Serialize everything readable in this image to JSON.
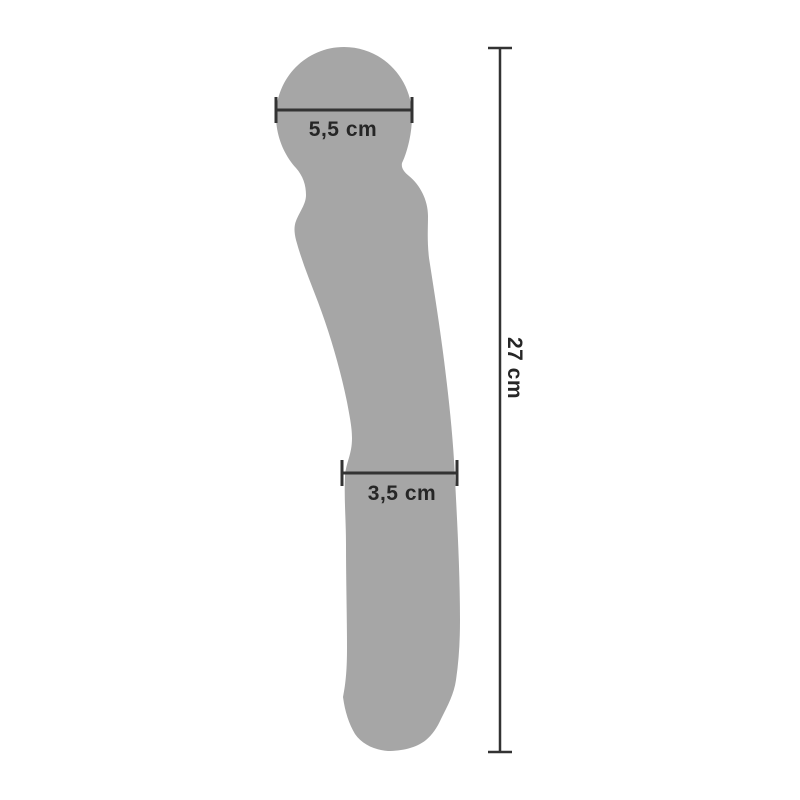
{
  "page": {
    "background": "#ffffff"
  },
  "product": {
    "name": "wand-massager-silhouette",
    "color": "#a6a6a6"
  },
  "dimensions": {
    "line_color": "#333333",
    "text_color": "#262626",
    "head_width": {
      "label": "5,5 cm",
      "orientation": "horizontal"
    },
    "body_width": {
      "label": "3,5 cm",
      "orientation": "horizontal"
    },
    "total_length": {
      "label": "27 cm",
      "orientation": "vertical"
    }
  }
}
